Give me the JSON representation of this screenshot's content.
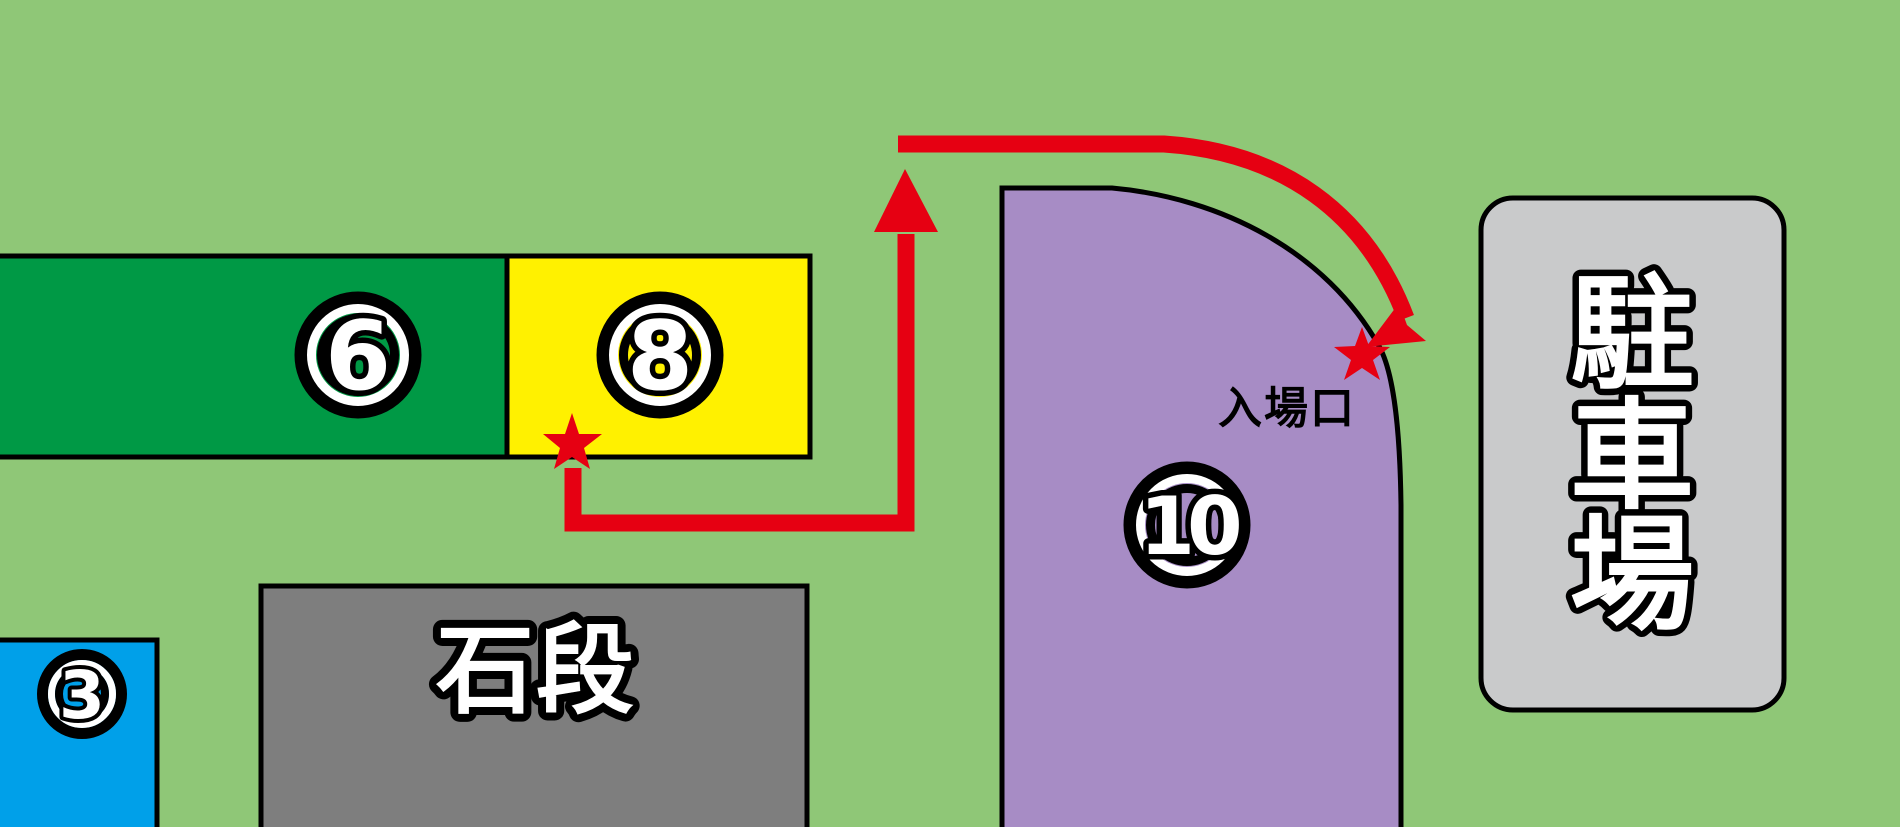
{
  "map": {
    "type": "venue-guide-map",
    "badges": {
      "six": "6",
      "eight": "8",
      "ten": "10",
      "three": "3"
    },
    "labels": {
      "stone_steps": "石段",
      "parking": "駐車場",
      "parking_chars": [
        "駐",
        "車",
        "場"
      ],
      "entrance": "入場口"
    },
    "markers": {
      "route_start": "star",
      "route_end": "star"
    },
    "colors": {
      "background": "#8FC777",
      "area6": "#009945",
      "area8": "#FFF100",
      "area10": "#A78CC5",
      "area3": "#00A0E9",
      "stone_steps": "#7E7E7E",
      "parking": "#C9CACB",
      "route": "#E60012",
      "outline": "#000000",
      "label_fill": "#FFFFFF",
      "entrance_text": "#000000"
    }
  }
}
